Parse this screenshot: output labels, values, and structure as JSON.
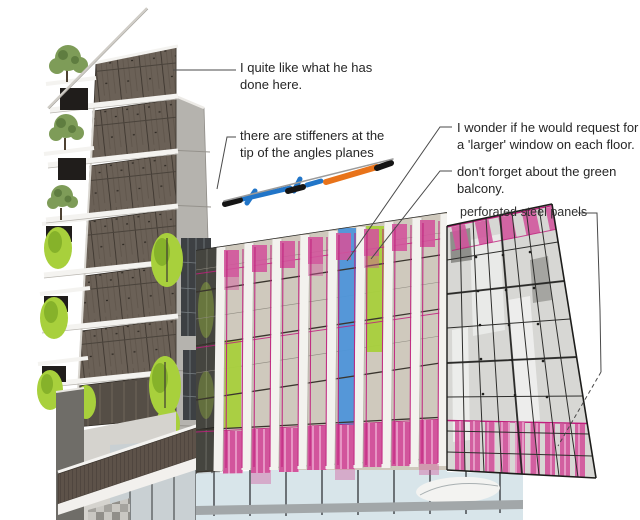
{
  "annotations": {
    "like": {
      "lines": [
        "I quite like what he has",
        "done here."
      ]
    },
    "stiffeners": {
      "lines": [
        "there are stiffeners at the",
        "tip of the angles planes"
      ]
    },
    "window": {
      "lines": [
        "I wonder if he would request for",
        "a 'larger' window on each floor."
      ]
    },
    "balcony": {
      "lines": [
        "don't forget about the green",
        "balcony."
      ]
    },
    "steel": {
      "lines": [
        "perforated steel panels"
      ]
    }
  },
  "palette": {
    "highlight_pink": "#d2559c",
    "magenta_line": "#c01f7d",
    "lime_green": "#a8d03c",
    "window_blue": "#4e95d9",
    "sketch_blue": "#2175c8",
    "sketch_orange": "#e8731a",
    "facade_beige": "#cfc9bd",
    "timber_brown": "#6b6157",
    "annotation_text": "#262626"
  }
}
